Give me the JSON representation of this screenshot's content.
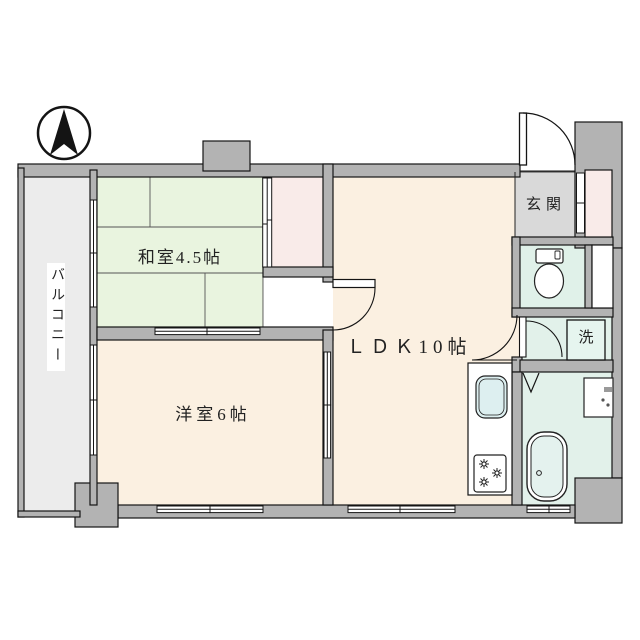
{
  "document": {
    "type": "apartment-floor-plan",
    "compass_direction": "N"
  },
  "floorplan": {
    "labels": {
      "washitsu": "和室4.5帖",
      "youshitsu": "洋室6帖",
      "ldk": "ＬＤＫ10帖",
      "genkan": "玄関",
      "laundry": "洗",
      "balcony": "バルコニー"
    },
    "rooms": [
      {
        "id": "washitsu",
        "label": "和室4.5帖",
        "floor": "tatami"
      },
      {
        "id": "youshitsu",
        "label": "洋室6帖",
        "floor": "wood"
      },
      {
        "id": "ldk",
        "label": "ＬＤＫ10帖",
        "floor": "wood"
      },
      {
        "id": "genkan",
        "label": "玄関",
        "floor": "concrete"
      },
      {
        "id": "toilet",
        "label": "",
        "floor": "wet"
      },
      {
        "id": "washroom",
        "label": "洗",
        "floor": "wet"
      },
      {
        "id": "bathroom",
        "label": "",
        "floor": "wet"
      },
      {
        "id": "closet",
        "label": "",
        "floor": "closet"
      },
      {
        "id": "balcony",
        "label": "バルコニー",
        "floor": "outdoor"
      }
    ],
    "fixtures": [
      "north-arrow",
      "entrance-door",
      "shoe-cabinet",
      "toilet",
      "washing-machine-space",
      "washbasin",
      "bathtub",
      "kitchen-sink",
      "gas-stove"
    ],
    "colors": {
      "wall": "#b3b3b3",
      "outline": "#141414",
      "tatami_green": "#e9f4df",
      "wood_cream": "#fbf0e1",
      "closet_pink": "#f9ebe9",
      "wet_mint": "#e2f1ea",
      "genkan_gray": "#d9d9d9",
      "balcony_gray": "#ececec",
      "sink_cyan": "#ddeff0"
    }
  }
}
